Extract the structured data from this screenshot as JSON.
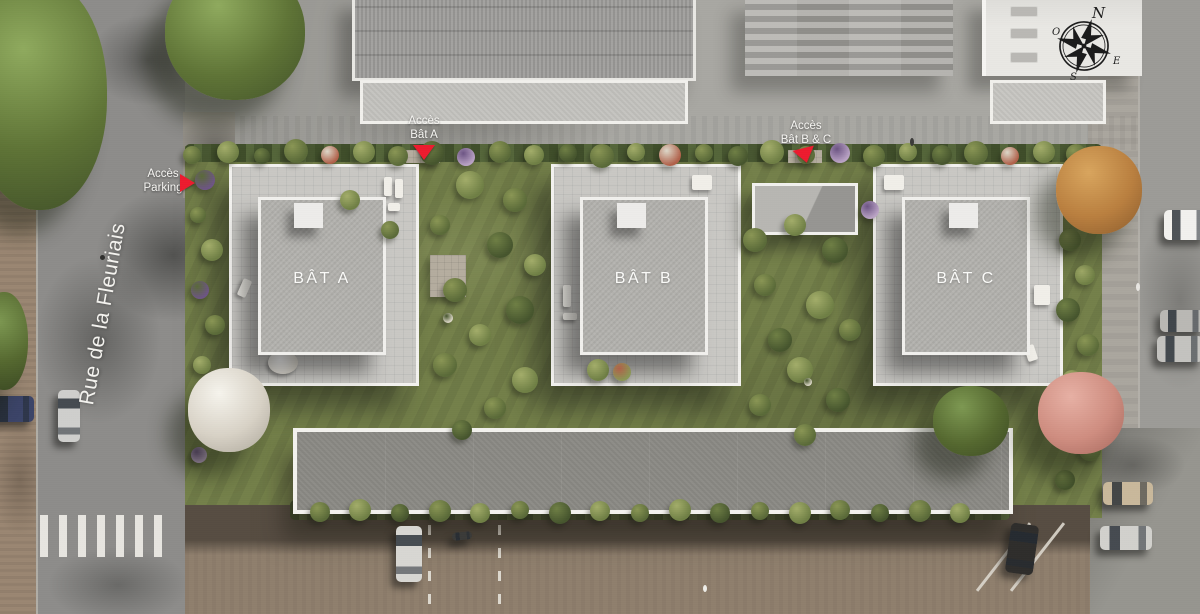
{
  "street": {
    "name": "Rue de la Fleuriais"
  },
  "access": [
    {
      "line1": "Accès",
      "line2": "Parking"
    },
    {
      "line1": "Accès",
      "line2": "Bât A"
    },
    {
      "line1": "Accès",
      "line2": "Bât B & C"
    }
  ],
  "buildings": [
    {
      "label": "BÂT A"
    },
    {
      "label": "BÂT B"
    },
    {
      "label": "BÂT C"
    }
  ],
  "compass": {
    "n": "N",
    "e": "E",
    "s": "S",
    "w": "O"
  },
  "colors": {
    "accent_red": "#ed1b2e",
    "road_gray": "#8d8c8a",
    "garden_green": "#74804a",
    "roof_gravel": "#b2b1ad",
    "parking_brown": "#8f7f6d",
    "white_trim": "#f3f2ef"
  }
}
